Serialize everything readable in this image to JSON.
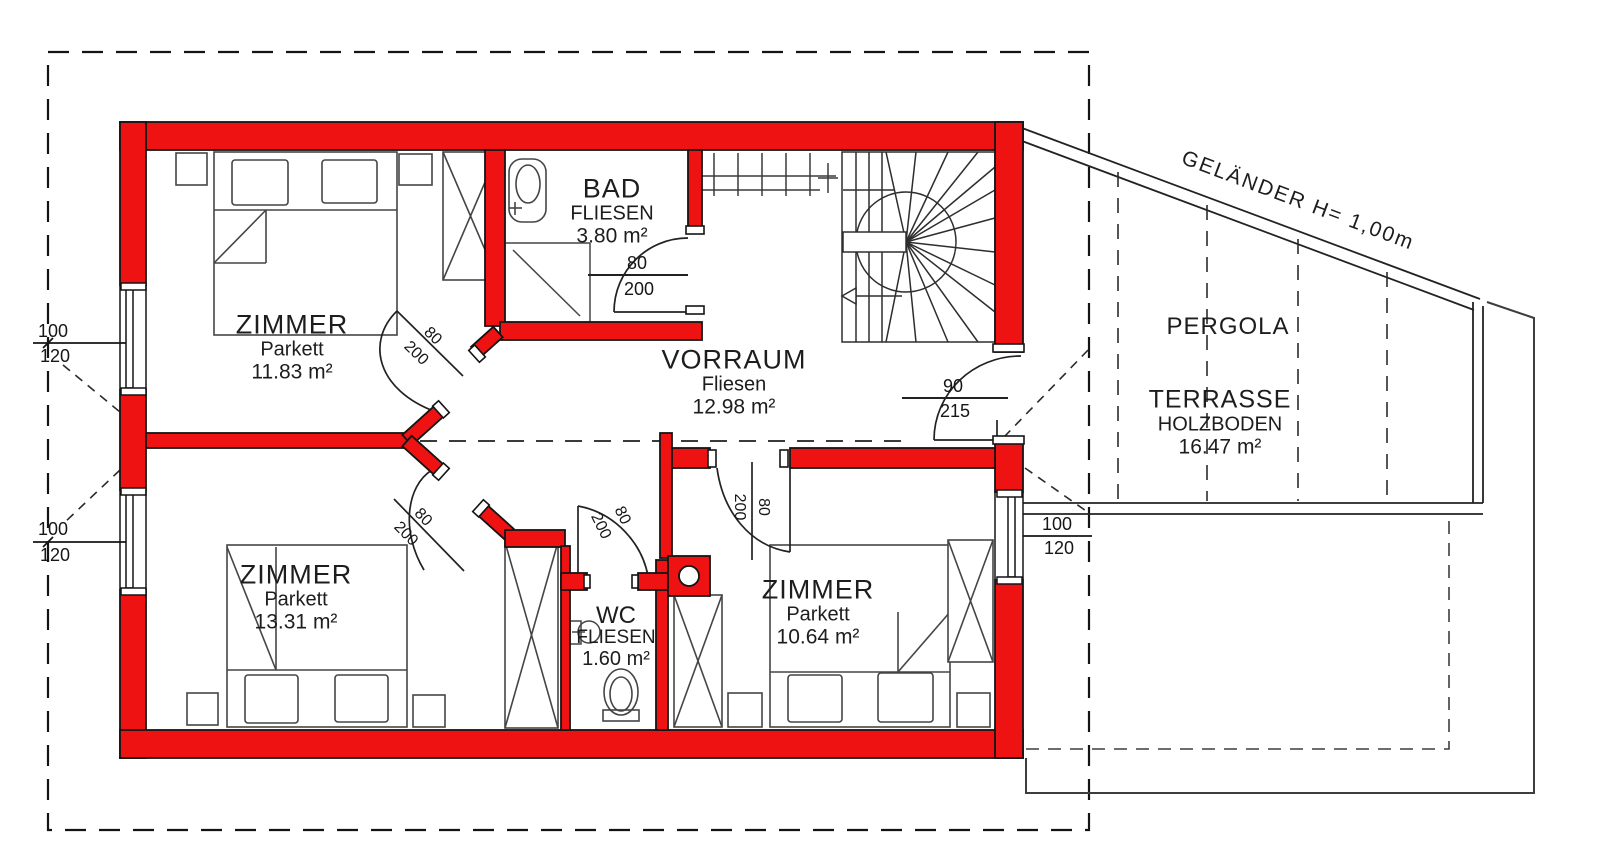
{
  "plan": {
    "rooms": [
      {
        "id": "zimmer-nw",
        "name": "ZIMMER",
        "floor": "Parkett",
        "area": "11.83 m²"
      },
      {
        "id": "bad",
        "name": "BAD",
        "floor": "FLIESEN",
        "area": "3.80 m²"
      },
      {
        "id": "vorraum",
        "name": "VORRAUM",
        "floor": "Fliesen",
        "area": "12.98 m²"
      },
      {
        "id": "zimmer-sw",
        "name": "ZIMMER",
        "floor": "Parkett",
        "area": "13.31 m²"
      },
      {
        "id": "wc",
        "name": "WC",
        "floor": "FLIESEN",
        "area": "1.60 m²"
      },
      {
        "id": "zimmer-se",
        "name": "ZIMMER",
        "floor": "Parkett",
        "area": "10.64 m²"
      },
      {
        "id": "terrasse",
        "name": "TERRASSE",
        "floor": "HOLZBODEN",
        "area": "16.47 m²"
      }
    ],
    "outdoor": {
      "pergola": "PERGOLA",
      "railing": "GELÄNDER H= 1,00m",
      "ski_rack": "SKISCHUHE"
    },
    "dims": {
      "window": {
        "w": "100",
        "h": "120"
      },
      "door": {
        "w": "80",
        "h": "200"
      },
      "entry": {
        "w": "90",
        "h": "215"
      }
    },
    "colors": {
      "wall": "#ee1212",
      "line": "#1c1c1c"
    }
  }
}
